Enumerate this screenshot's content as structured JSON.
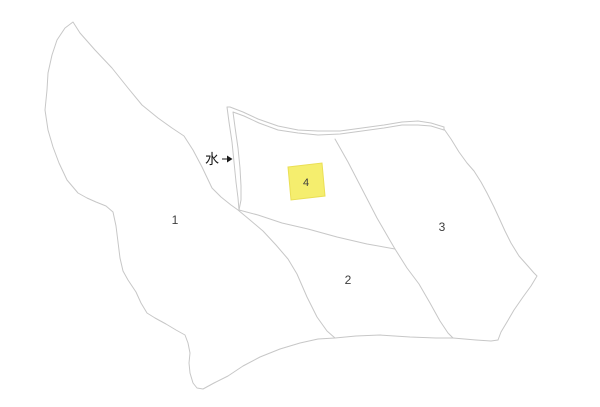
{
  "canvas": {
    "width": 600,
    "height": 407,
    "background": "#ffffff"
  },
  "style": {
    "parcel_line_color": "#c7c7c7",
    "label_color": "#3d3d3d",
    "annotation_color": "#1a1a1a",
    "highlight_fill": "#f5ee6e",
    "highlight_edge": "#eadf55"
  },
  "parcels": [
    {
      "id": "parcel-1",
      "label": "1"
    },
    {
      "id": "parcel-2",
      "label": "2"
    },
    {
      "id": "parcel-3",
      "label": "3"
    },
    {
      "id": "parcel-4",
      "label": "4",
      "highlighted": true
    }
  ],
  "annotations": [
    {
      "id": "water-channel",
      "text": "水"
    }
  ]
}
